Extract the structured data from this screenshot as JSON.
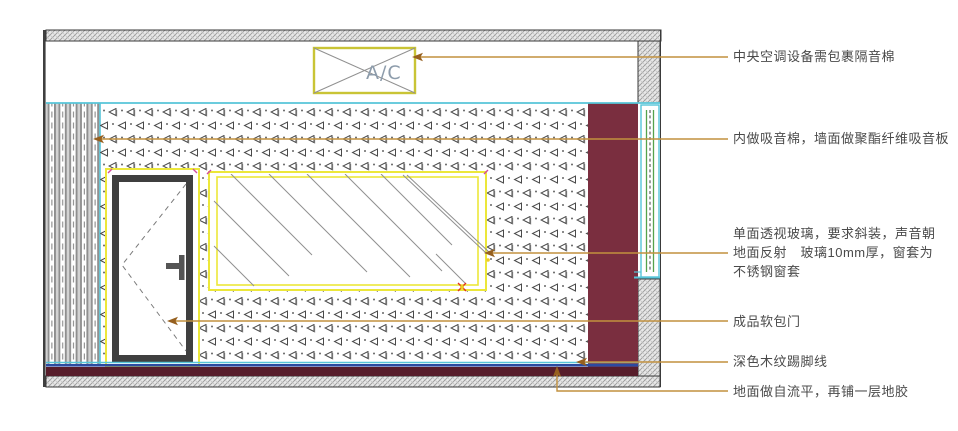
{
  "drawing": {
    "title": "room-elevation-section",
    "ac_label": "A/C"
  },
  "annotations": [
    {
      "id": "ac-insulation",
      "label": "中央空调设备需包裹隔音棉"
    },
    {
      "id": "wall-absorber",
      "label": "内做吸音棉，墙面做聚酯纤维吸音板"
    },
    {
      "id": "one-way-glass",
      "label": "单面透视玻璃，要求斜装，声音朝\n地面反射　玻璃10mm厚，窗套为\n不锈钢窗套"
    },
    {
      "id": "soft-door",
      "label": "成品软包门"
    },
    {
      "id": "skirting",
      "label": "深色木纹踢脚线"
    },
    {
      "id": "floor",
      "label": "地面做自流平，再铺一层地胶"
    }
  ],
  "colors": {
    "cyan": "#56c5d8",
    "yellow": "#ece73a",
    "yellowDim": "#c9c435",
    "gold": "#c2913f",
    "goldDark": "#96601f",
    "maroon": "#7a2e3f",
    "skirting": "#571d2b",
    "navy": "#2b4aa0",
    "green": "#55a24a",
    "magenta": "#d24a9e",
    "red": "#e03020",
    "dotYellow": "#eecb2a",
    "frameDark": "#3f3f3f",
    "hatchLine": "#9a9a9a",
    "glassLine": "#909090",
    "acText": "#8d9cab",
    "textColor": "#4a4a4a"
  }
}
